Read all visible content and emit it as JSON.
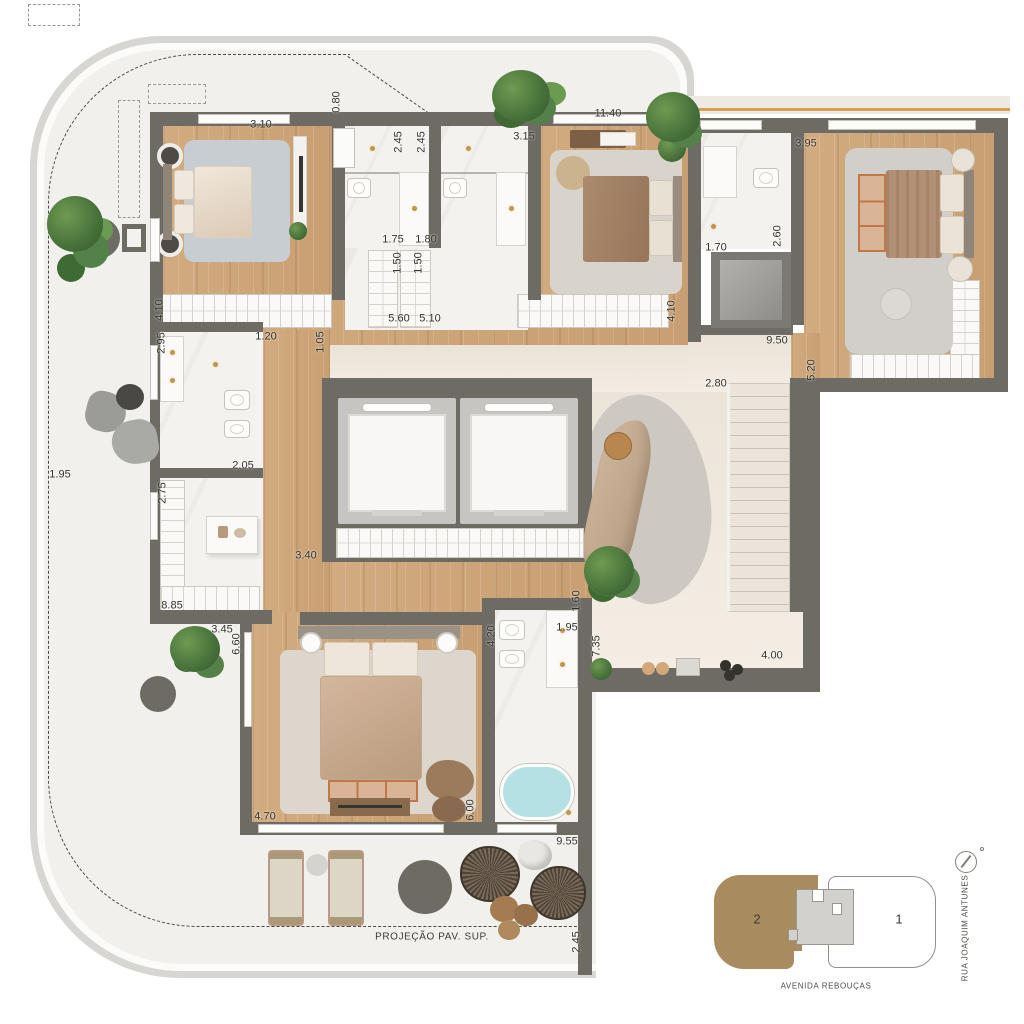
{
  "plan": {
    "type": "apartment-floor-plan",
    "projection_note": "PROJEÇÃO PAV. SUP.",
    "dimension_labels": [
      {
        "text": "3.10",
        "x": 261,
        "y": 125,
        "rot": 0
      },
      {
        "text": "0.80",
        "x": 337,
        "y": 102,
        "rot": 90
      },
      {
        "text": "2.45",
        "x": 399,
        "y": 142,
        "rot": 90
      },
      {
        "text": "2.45",
        "x": 422,
        "y": 142,
        "rot": 90
      },
      {
        "text": "3.15",
        "x": 524,
        "y": 137,
        "rot": 0
      },
      {
        "text": "11.40",
        "x": 608,
        "y": 114,
        "rot": 0
      },
      {
        "text": "3.95",
        "x": 806,
        "y": 144,
        "rot": 0
      },
      {
        "text": "1.75",
        "x": 393,
        "y": 240,
        "rot": 0
      },
      {
        "text": "1.80",
        "x": 426,
        "y": 240,
        "rot": 0
      },
      {
        "text": "1.70",
        "x": 716,
        "y": 248,
        "rot": 0
      },
      {
        "text": "2.60",
        "x": 778,
        "y": 236,
        "rot": 90
      },
      {
        "text": "1.50",
        "x": 398,
        "y": 263,
        "rot": 90
      },
      {
        "text": "1.50",
        "x": 419,
        "y": 263,
        "rot": 90
      },
      {
        "text": "4.10",
        "x": 160,
        "y": 310,
        "rot": 90
      },
      {
        "text": "4.10",
        "x": 672,
        "y": 311,
        "rot": 90
      },
      {
        "text": "5.60",
        "x": 399,
        "y": 319,
        "rot": 0
      },
      {
        "text": "5.10",
        "x": 430,
        "y": 319,
        "rot": 0
      },
      {
        "text": "9.50",
        "x": 777,
        "y": 341,
        "rot": 0
      },
      {
        "text": "5.20",
        "x": 812,
        "y": 370,
        "rot": 90
      },
      {
        "text": "2.95",
        "x": 162,
        "y": 343,
        "rot": 90
      },
      {
        "text": "1.20",
        "x": 266,
        "y": 337,
        "rot": 0
      },
      {
        "text": "1.05",
        "x": 321,
        "y": 342,
        "rot": 90
      },
      {
        "text": "1.95",
        "x": 60,
        "y": 475,
        "rot": 0
      },
      {
        "text": "2.05",
        "x": 243,
        "y": 466,
        "rot": 0
      },
      {
        "text": "2.75",
        "x": 163,
        "y": 493,
        "rot": 90
      },
      {
        "text": "3.40",
        "x": 306,
        "y": 556,
        "rot": 0
      },
      {
        "text": "2.80",
        "x": 716,
        "y": 384,
        "rot": 0
      },
      {
        "text": "1.60",
        "x": 577,
        "y": 601,
        "rot": 90
      },
      {
        "text": "8.85",
        "x": 172,
        "y": 606,
        "rot": 0
      },
      {
        "text": "3.45",
        "x": 222,
        "y": 630,
        "rot": 0
      },
      {
        "text": "6.60",
        "x": 237,
        "y": 644,
        "rot": 90
      },
      {
        "text": "4.20",
        "x": 492,
        "y": 636,
        "rot": 90
      },
      {
        "text": "1.95",
        "x": 567,
        "y": 628,
        "rot": 0
      },
      {
        "text": "7.35",
        "x": 597,
        "y": 646,
        "rot": 90
      },
      {
        "text": "4.00",
        "x": 772,
        "y": 656,
        "rot": 0
      },
      {
        "text": "4.70",
        "x": 265,
        "y": 817,
        "rot": 0
      },
      {
        "text": "6.00",
        "x": 471,
        "y": 810,
        "rot": 90
      },
      {
        "text": "9.55",
        "x": 567,
        "y": 842,
        "rot": 0
      },
      {
        "text": "2.45",
        "x": 577,
        "y": 942,
        "rot": 90
      }
    ],
    "colors": {
      "wall": "#6e6b64",
      "wood_floor": "#cda67c",
      "marble_floor": "#f3f2ef",
      "living_floor": "#efe7db",
      "terrace_floor": "#f2f0ec",
      "pergola_accent": "#d59e52",
      "tub_water": "#b5e0e4",
      "fixture_gold": "#c2964a",
      "label_text": "#34332e"
    }
  },
  "minimap": {
    "unit_highlighted_label": "2",
    "unit_other_label": "1",
    "street_bottom": "AVENIDA REBOUÇAS",
    "street_right": "RUA JOAQUIM ANTUNES",
    "highlight_color": "#a98b60",
    "icons": [
      "compass-icon"
    ]
  }
}
